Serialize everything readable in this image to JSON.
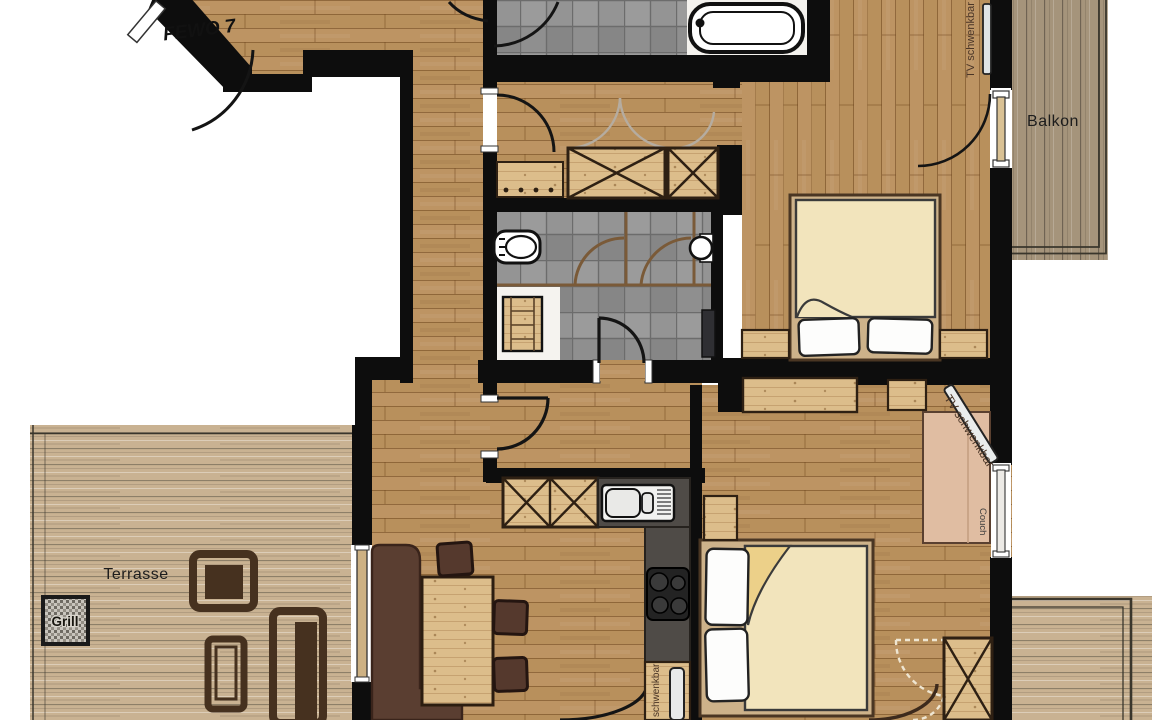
{
  "plan": {
    "entry_label": "FEWO 7",
    "rooms": {
      "balcony": "Balkon",
      "terrace": "Terrasse"
    },
    "items": {
      "grill": "Grill",
      "couch": "Couch",
      "tv_bedroom_top": "TV schwenkbar",
      "tv_living": "TV schwenkbar",
      "tv_bedroom_bottom": "schwenkbar"
    },
    "colors": {
      "wall": "#0d0d0d",
      "floor_wood": "#b8905c",
      "terrace_deck": "#c9b292",
      "balcony_deck": "#a5947b",
      "tile": "#8f8f8f",
      "furniture_spruce": "#dcbd8b",
      "furniture_dark": "#4a3322",
      "counter": "#4f4b47",
      "duvet": "#f2e4bc",
      "couch": "#e0bda2",
      "pillow": "#fdfdfc"
    }
  }
}
